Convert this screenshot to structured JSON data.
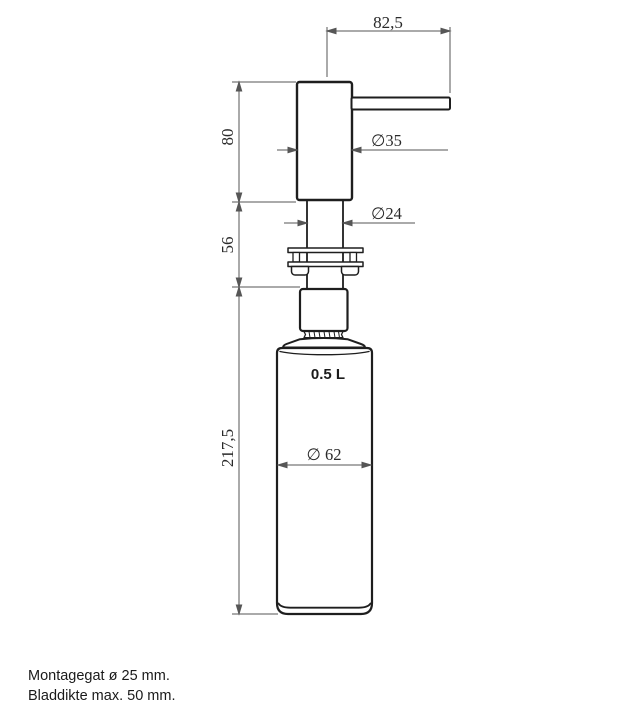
{
  "drawing": {
    "dimensions": {
      "spout_projection": "82,5",
      "head_height": "80",
      "neck_height": "56",
      "body_height": "217,5",
      "head_diameter": "∅35",
      "shaft_diameter": "∅24",
      "body_diameter": "∅ 62"
    },
    "capacity_label": "0.5 L",
    "notes": {
      "mounting_hole": "Montagegat ø 25 mm.",
      "max_thickness": "Bladdikte max. 50 mm."
    },
    "colors": {
      "object_line": "#1e1e1e",
      "dimension_line": "#565656",
      "dimension_text": "#2a2a2a",
      "background": "#ffffff"
    }
  }
}
